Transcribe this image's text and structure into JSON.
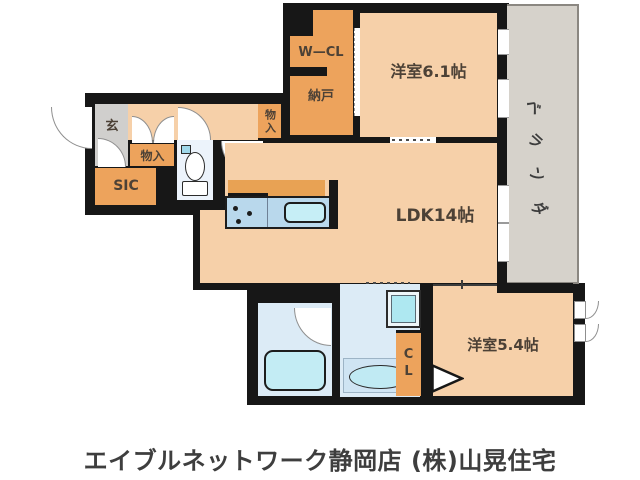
{
  "plan": {
    "type": "japanese-apartment-floorplan",
    "rooms": {
      "wcl": "W—CL",
      "nando": "納戸",
      "bedroom1": "洋室6.1帖",
      "balcony": "ベランダ",
      "balcony_chars": [
        "ベ",
        "ラ",
        "ン",
        "ダ"
      ],
      "genkan": "玄",
      "monoire1": "物入",
      "monoire2": "物入",
      "sic": "SIC",
      "ldk": "LDK14帖",
      "cl": "CL",
      "bedroom2": "洋室5.4帖"
    },
    "fixtures": [
      "toilet",
      "kitchen-sink",
      "stove",
      "bathtub",
      "washbasin",
      "washing-machine"
    ],
    "colors": {
      "wall": "#171717",
      "room_floor": "#f6d0a9",
      "closet_floor": "#eda35c",
      "entrance_tile": "#d0cfcd",
      "wet_area": "#dcebf6",
      "counter_blue": "#b9d8ec",
      "fixture_cyan": "#c6eef6",
      "balcony_gray": "#d6d2cb",
      "label_text": "#4c4136"
    }
  },
  "footer": {
    "caption": "エイブルネットワーク静岡店 (株)山晃住宅"
  }
}
